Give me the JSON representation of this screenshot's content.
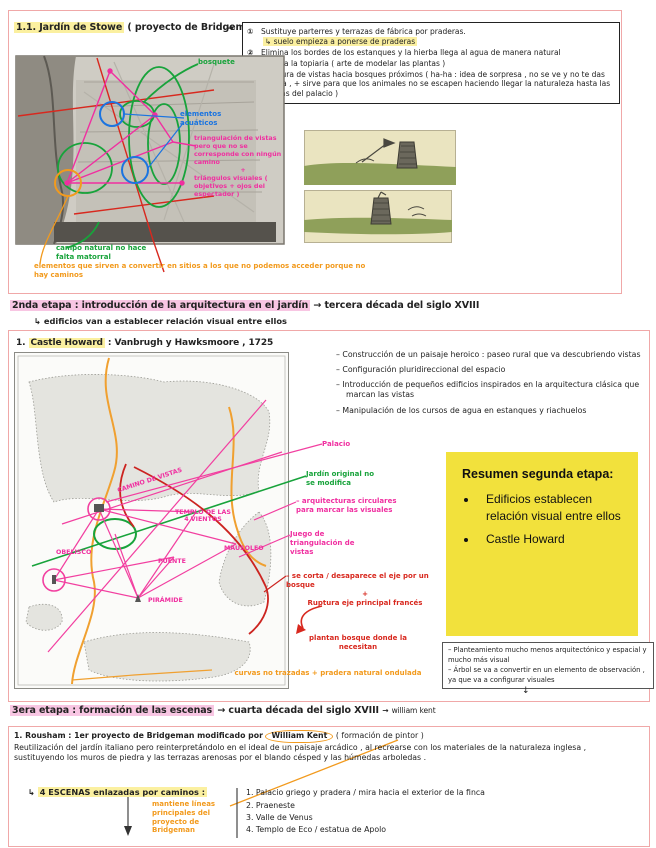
{
  "colors": {
    "annotation_pink": "#f02fa0",
    "annotation_green": "#18a33b",
    "annotation_blue": "#1b74e0",
    "annotation_red": "#d8281e",
    "annotation_orange": "#f29a1d",
    "summary_yellow": "#f2e13c",
    "highlight_yellow": "#fbf0a0",
    "highlight_pink": "#f8c6e3",
    "section_border_pink": "#f0a8a8"
  },
  "s1": {
    "title_hl": "1.1. Jardín de Stowe",
    "title_rest": "( proyecto de Bridgeman )",
    "arrow": "→",
    "rules": [
      {
        "num": "①",
        "text": "Sustituye parterres y terrazas de fábrica por praderas.",
        "sub": "↳ suelo empieza a ponerse de praderas"
      },
      {
        "num": "②",
        "text": "Elimina los bordes de los estanques y la hierba llega al agua de manera natural"
      },
      {
        "num": "③",
        "text": "Elimina la topiaria ( arte de modelar las plantas )"
      },
      {
        "num": "④",
        "text": "Apertura de vistas hacia bosques próximos ( ha-ha : idea de sorpresa , no se ve y no te das cuenta , + sirve para que los animales no se escapen haciendo llegar la naturaleza hasta las puertas del palacio )"
      }
    ],
    "labels": {
      "bosquete": "bosquete",
      "acuaticos": "elementos acuáticos",
      "triang1": "triangulación de vistas pero que no se corresponde con ningún camino",
      "plus": "+",
      "triang2": "triángulos visuales ( objetivos + ojos del espectador )",
      "campo": "campo natural no hace falta matorral",
      "nota": "elementos que sirven a convertir en sitios a los que no podemos acceder porque no hay caminos"
    }
  },
  "s2": {
    "h_hl": "2nda etapa : introducción de la arquitectura en el jardín",
    "h_arrow": "→",
    "h_rest": "tercera década del siglo XVIII",
    "h_sub": "↳ edificios van a establecer relación visual entre ellos",
    "title_pre": "1.",
    "title_hl": "Castle Howard",
    "title_rest": ": Vanbrugh y Hawksmoore , 1725",
    "bullets": [
      "– Construcción de un paisaje heroico : paseo rural que va descubriendo vistas",
      "– Configuración pluridireccional del espacio",
      "– Introducción de pequeños edificios inspirados en la arquitectura clásica que marcan las vistas",
      "– Manipulación de los cursos de agua en estanques y riachuelos"
    ],
    "map_labels": {
      "camino": "CAMINO DE VISTAS",
      "templo": "TEMPLO DE LAS 4 VIENTOS",
      "mausoleo": "MAUSOLEO",
      "puente": "PUENTE",
      "obelisco": "OBELISCO",
      "piramide": "PIRÁMIDE"
    },
    "side_labels": {
      "palacio": "Palacio",
      "jardin": "Jardín original no se modifica",
      "arquitecturas": "– arquitecturas circulares para marcar las visuales",
      "juego": "Juego de triangulación de vistas",
      "curvas": "curvas no trazadas + pradera natural ondulada"
    },
    "red_note": {
      "l1": "– se corta / desaparece el eje por un bosque",
      "plus": "+",
      "l2": "Ruptura eje principal francés",
      "l3": "plantan bosque donde la necesitan"
    },
    "resumen": {
      "title": "Resumen segunda etapa:",
      "items": [
        "Edificios establecen relación visual entre ellos",
        "Castle Howard"
      ]
    },
    "gray_box": [
      "– Planteamiento mucho menos arquitectónico y espacial y mucho más visual",
      "– Árbol se va a convertir en un elemento de observación , ya que va a configurar visuales"
    ],
    "gray_box_arrow": "↓"
  },
  "s3": {
    "h_hl": "3era etapa : formación de las escenas",
    "arrow1": "→",
    "h_mid": "cuarta década del siglo XVIII",
    "arrow2": "→",
    "h_kent": "william kent",
    "p1_pre": "1. Rousham : 1er proyecto de Bridgeman modificado por",
    "kent": "William Kent",
    "p1_post": "( formación de pintor )",
    "p2": "Reutilización del jardín italiano pero reinterpretándolo en el ideal de un paisaje arcádico , al recrearse con los materiales de la naturaleza inglesa , sustituyendo los muros de piedra y las terrazas arenosas por el blando césped y las húmedas arboledas .",
    "escenas_pre": "↳",
    "escenas_hl": "4 ESCENAS enlazadas por caminos :",
    "escenas": [
      "1. Palacio griego y pradera / mira hacia el exterior de la finca",
      "2. Praeneste",
      "3. Valle de Venus",
      "4. Templo de Eco / estatua de Apolo"
    ],
    "nota": "mantiene líneas principales del proyecto de Bridgeman"
  }
}
